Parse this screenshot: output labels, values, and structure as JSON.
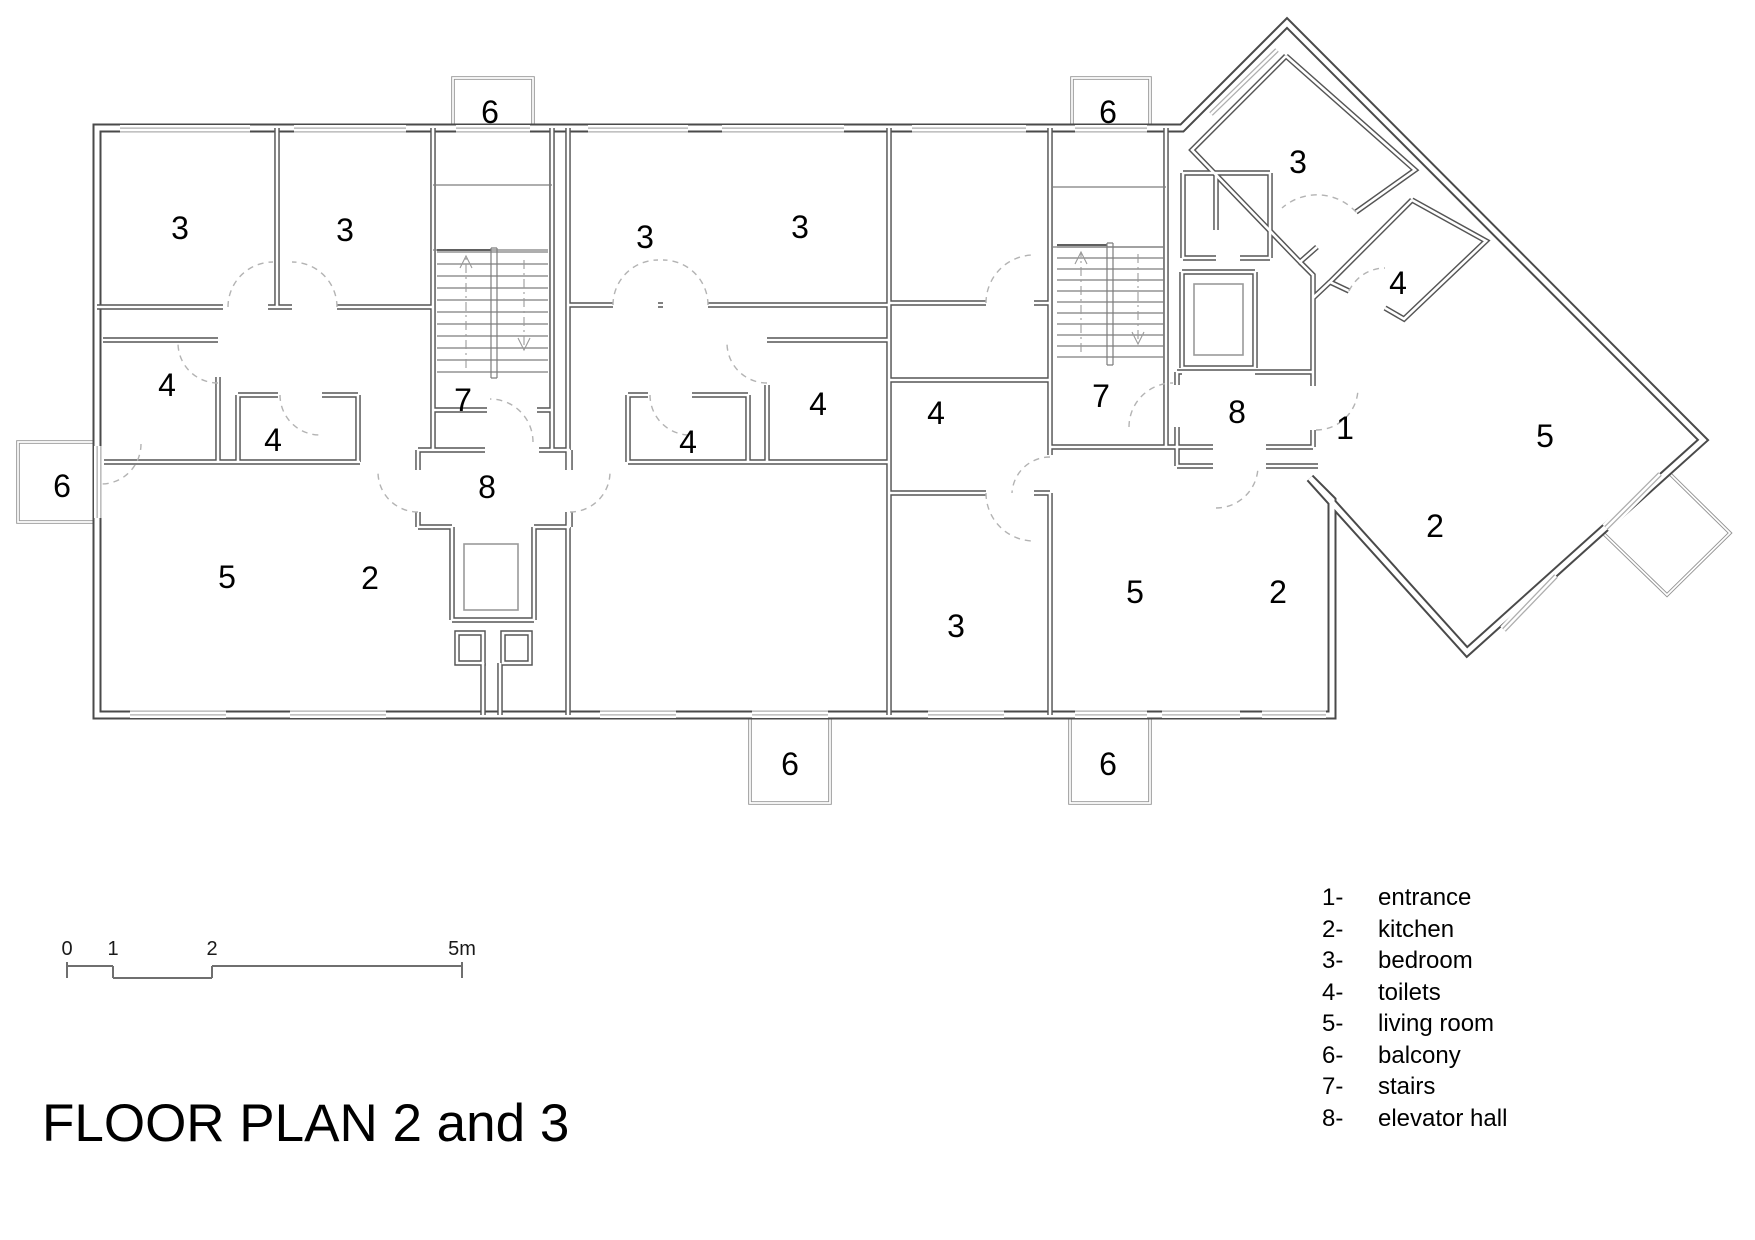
{
  "title": "FLOOR PLAN 2 and 3",
  "legend": {
    "items": [
      {
        "num": "1-",
        "label": "entrance"
      },
      {
        "num": "2-",
        "label": "kitchen"
      },
      {
        "num": "3-",
        "label": "bedroom"
      },
      {
        "num": "4-",
        "label": "toilets"
      },
      {
        "num": "5-",
        "label": "living room"
      },
      {
        "num": "6-",
        "label": "balcony"
      },
      {
        "num": "7-",
        "label": "stairs"
      },
      {
        "num": "8-",
        "label": "elevator hall"
      }
    ]
  },
  "scale_bar": {
    "unit": "m",
    "labels": [
      {
        "text": "0",
        "x": 67
      },
      {
        "text": "1",
        "x": 113
      },
      {
        "text": "2",
        "x": 212
      },
      {
        "text": "5m",
        "x": 462
      }
    ]
  },
  "plan": {
    "room_labels": [
      {
        "text": "3",
        "x": 180,
        "y": 228
      },
      {
        "text": "3",
        "x": 345,
        "y": 230
      },
      {
        "text": "4",
        "x": 167,
        "y": 385
      },
      {
        "text": "4",
        "x": 273,
        "y": 440
      },
      {
        "text": "5",
        "x": 227,
        "y": 577
      },
      {
        "text": "2",
        "x": 370,
        "y": 578
      },
      {
        "text": "7",
        "x": 463,
        "y": 400
      },
      {
        "text": "8",
        "x": 487,
        "y": 487
      },
      {
        "text": "6",
        "x": 490,
        "y": 112
      },
      {
        "text": "6",
        "x": 62,
        "y": 486
      },
      {
        "text": "6",
        "x": 790,
        "y": 764
      },
      {
        "text": "3",
        "x": 645,
        "y": 237
      },
      {
        "text": "3",
        "x": 800,
        "y": 227
      },
      {
        "text": "4",
        "x": 688,
        "y": 442
      },
      {
        "text": "4",
        "x": 818,
        "y": 404
      },
      {
        "text": "3",
        "x": 956,
        "y": 626
      },
      {
        "text": "4",
        "x": 936,
        "y": 413
      },
      {
        "text": "5",
        "x": 1135,
        "y": 592
      },
      {
        "text": "2",
        "x": 1278,
        "y": 592
      },
      {
        "text": "7",
        "x": 1101,
        "y": 396
      },
      {
        "text": "8",
        "x": 1237,
        "y": 412
      },
      {
        "text": "6",
        "x": 1108,
        "y": 112
      },
      {
        "text": "6",
        "x": 1108,
        "y": 764
      },
      {
        "text": "1",
        "x": 1345,
        "y": 428
      },
      {
        "text": "3",
        "x": 1298,
        "y": 162
      },
      {
        "text": "4",
        "x": 1398,
        "y": 283
      },
      {
        "text": "5",
        "x": 1545,
        "y": 436
      },
      {
        "text": "2",
        "x": 1435,
        "y": 526
      }
    ]
  }
}
